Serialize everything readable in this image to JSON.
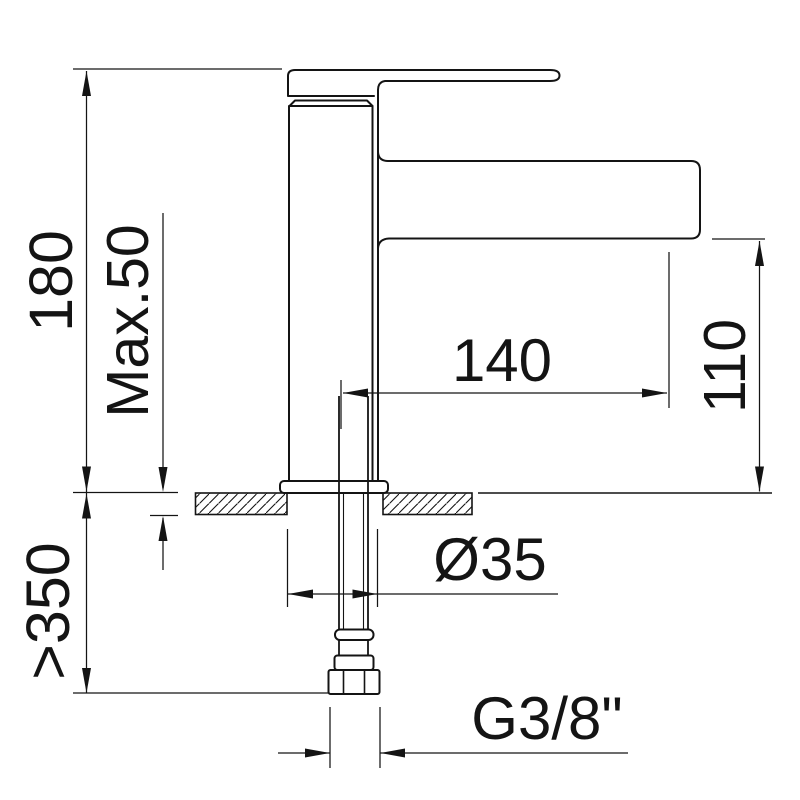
{
  "drawing": {
    "background": "#ffffff",
    "line_color": "#141414",
    "labels": {
      "overall_height": "180",
      "max_deck_thickness": "Max.50",
      "min_clearance_below": ">350",
      "spout_reach": "140",
      "spout_height": "110",
      "body_diameter": "Ø35",
      "connection_thread": "G3/8\""
    }
  }
}
